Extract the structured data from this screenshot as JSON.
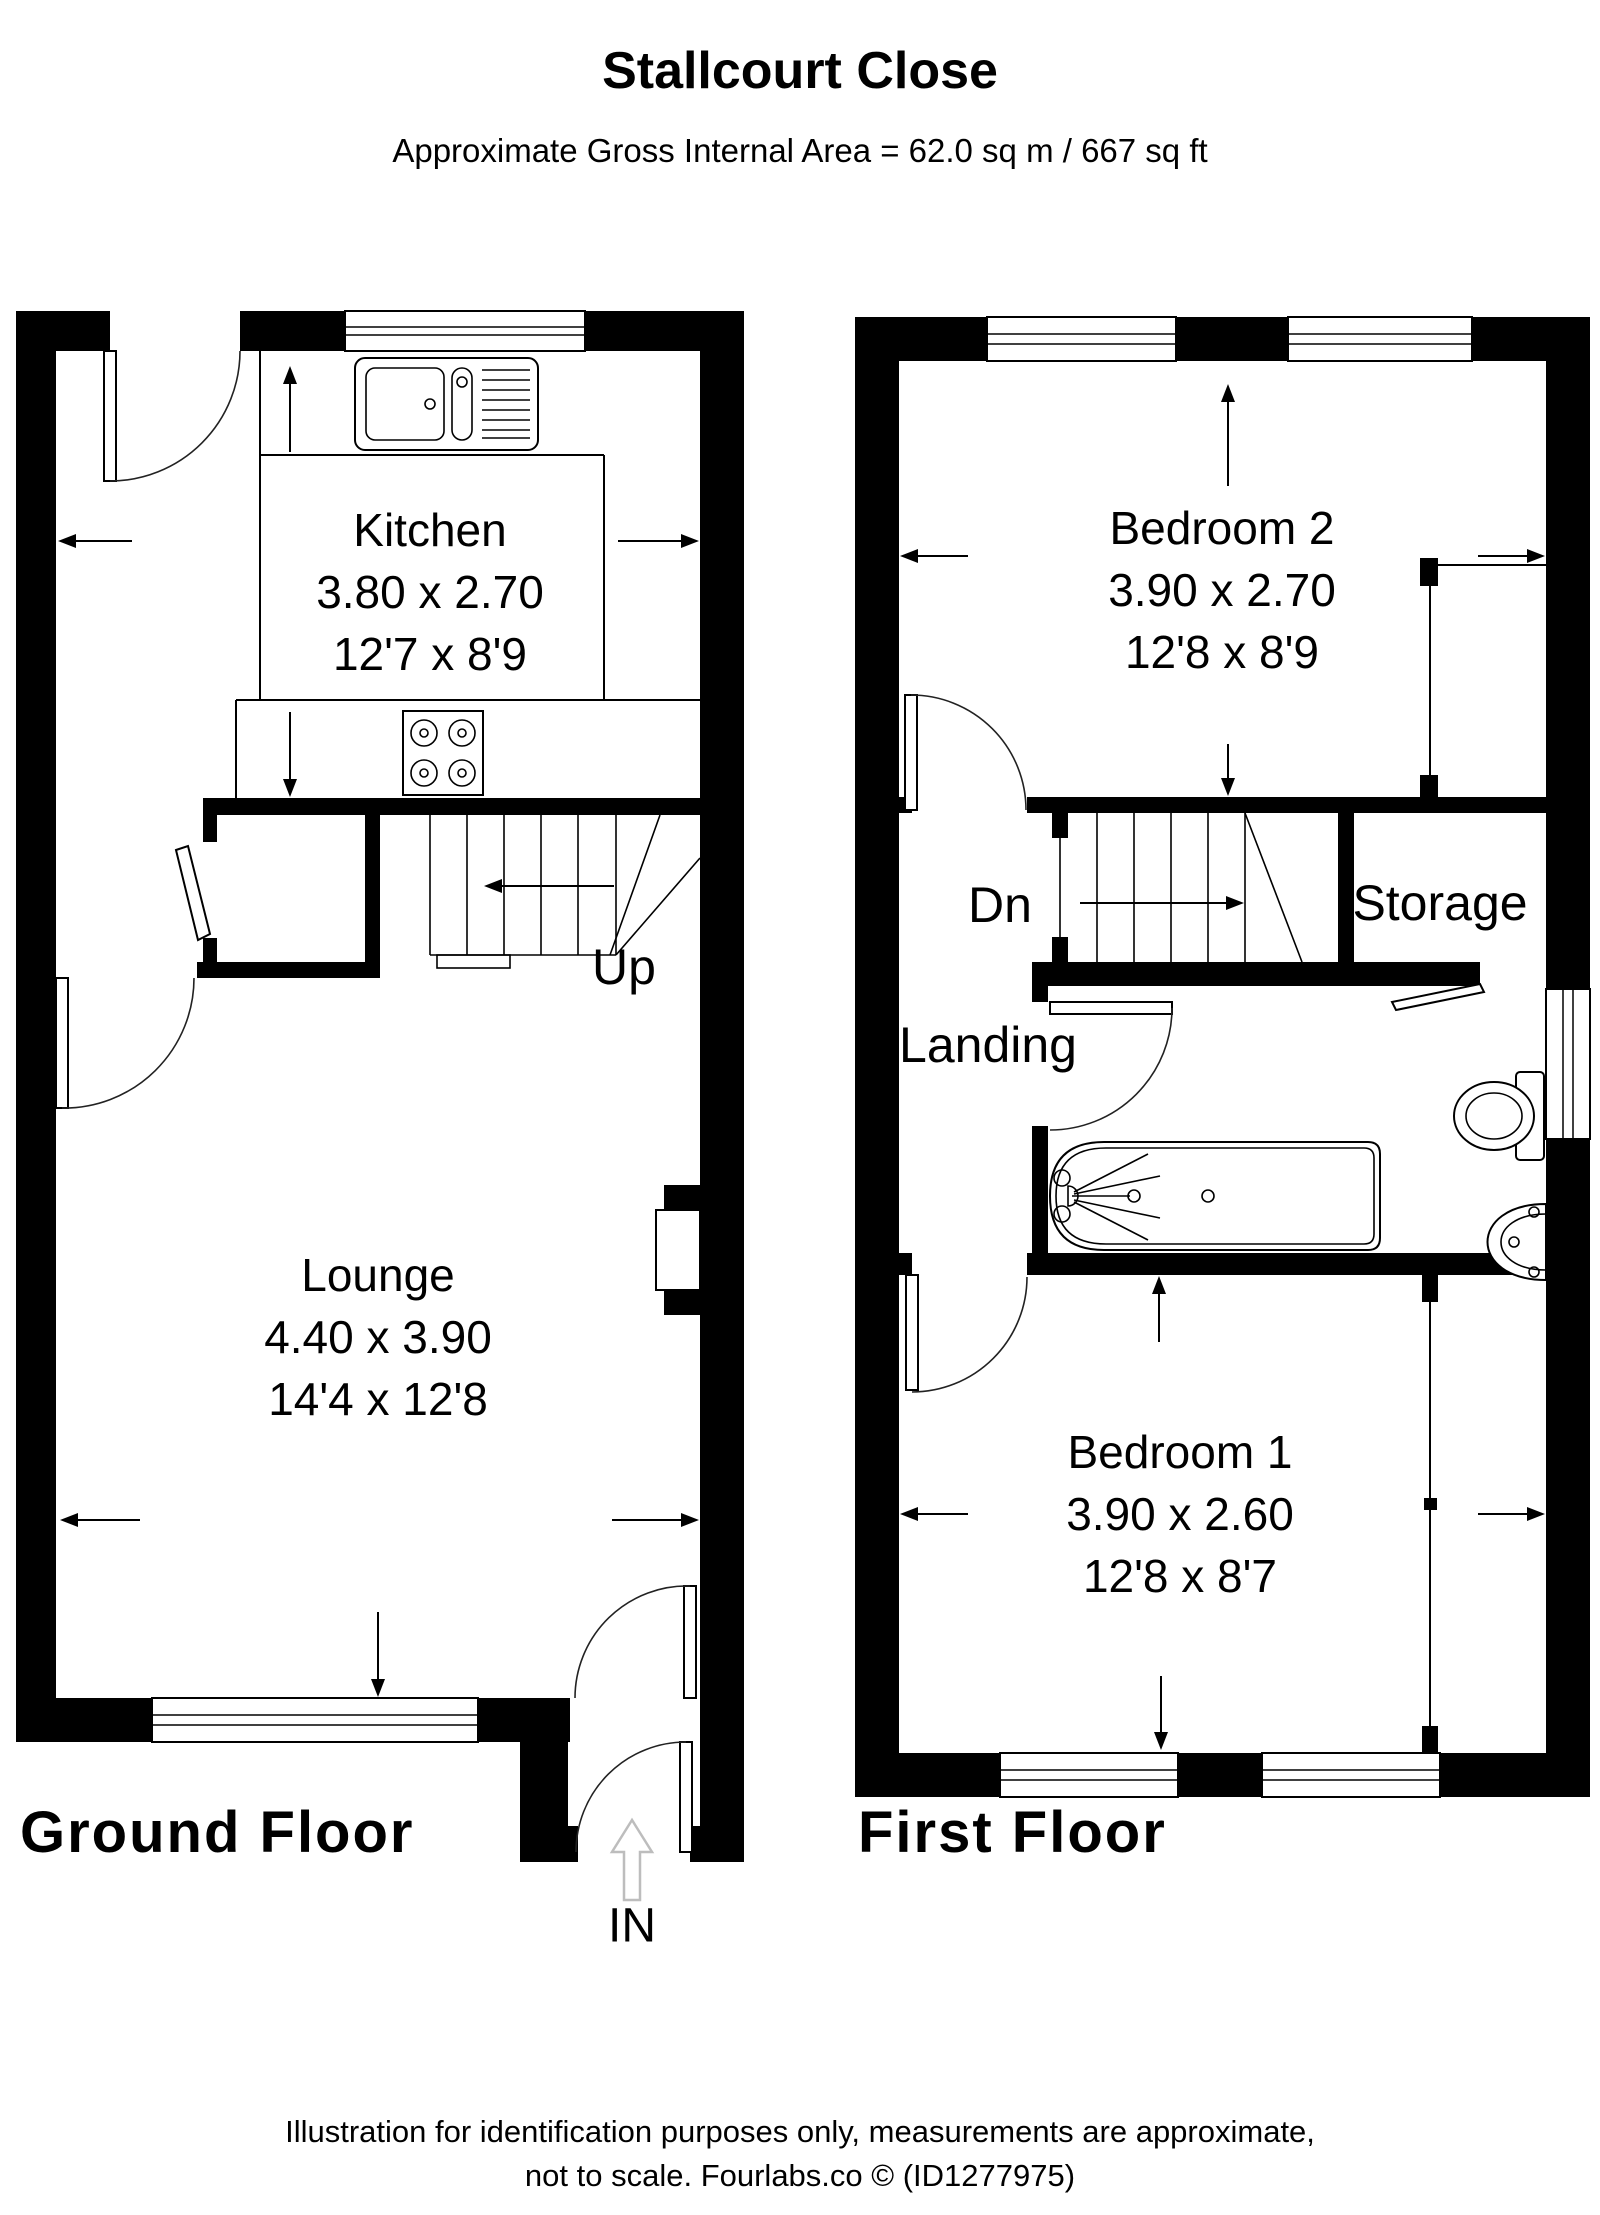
{
  "title": "Stallcourt Close",
  "subtitle": "Approximate Gross Internal Area = 62.0 sq m / 667 sq ft",
  "ground_floor": {
    "label": "Ground Floor",
    "kitchen": {
      "name": "Kitchen",
      "metric": "3.80 x 2.70",
      "imperial": "12'7 x 8'9"
    },
    "lounge": {
      "name": "Lounge",
      "metric": "4.40 x 3.90",
      "imperial": "14'4 x 12'8"
    },
    "stairs_label": "Up",
    "entrance_label": "IN"
  },
  "first_floor": {
    "label": "First Floor",
    "bedroom2": {
      "name": "Bedroom 2",
      "metric": "3.90 x 2.70",
      "imperial": "12'8 x 8'9"
    },
    "bedroom1": {
      "name": "Bedroom 1",
      "metric": "3.90 x 2.60",
      "imperial": "12'8 x 8'7"
    },
    "storage_label": "Storage",
    "landing_label": "Landing",
    "stairs_label": "Dn"
  },
  "footer": {
    "line1": "Illustration for identification purposes only, measurements are approximate,",
    "line2": "not to scale. Fourlabs.co © (ID1277975)"
  },
  "colors": {
    "wall": "#000000",
    "arrow_gray": "#bdbdbd"
  }
}
